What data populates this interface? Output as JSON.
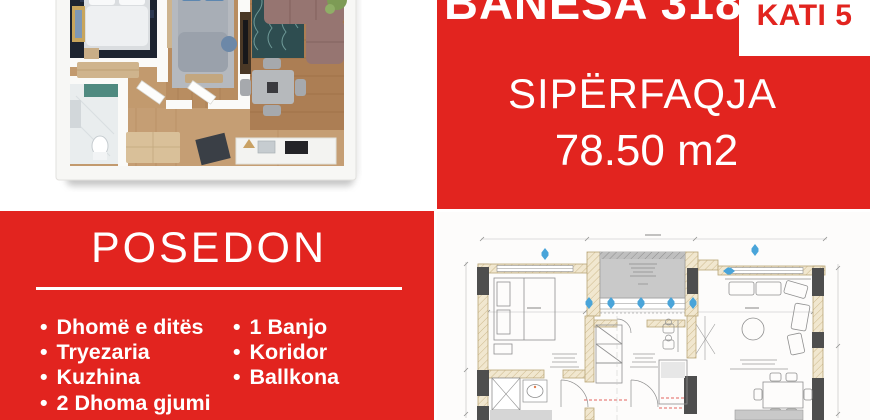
{
  "theme": {
    "brand_red": "#e2241f",
    "panel_text_white": "#ffffff",
    "plan_window_blue": "#49a4d9",
    "plan_balcony_gray": "#c9c9c9",
    "plan_wall_beige": "#f1e7cf",
    "plan_column_dark": "#4e4e4e"
  },
  "unit_panel": {
    "title": "BANESA 318",
    "floor_badge": "KATI 5",
    "area_label": "SIPËRFAQJA",
    "area_value": "78.50 m2"
  },
  "features_panel": {
    "title": "POSEDON",
    "bullet": "•",
    "left_items": [
      "Dhomë e ditës",
      "Tryezaria",
      "Kuzhina",
      "2 Dhoma gjumi"
    ],
    "right_items": [
      "1 Banjo",
      "Koridor",
      "Ballkona"
    ]
  }
}
